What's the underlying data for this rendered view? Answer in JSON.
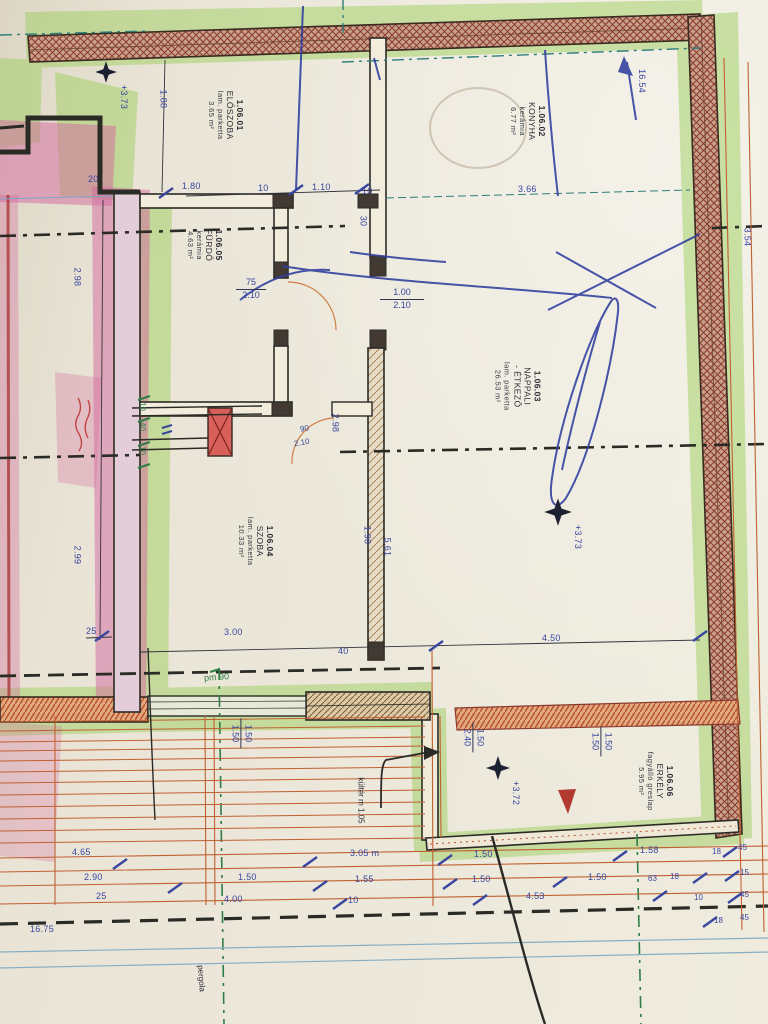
{
  "plan": {
    "rooms": [
      {
        "num": "1.06.01",
        "name": "ELŐSZOBA",
        "finish": "lam. parketta",
        "area": "3.65 m²"
      },
      {
        "num": "1.06.02",
        "name": "KONYHA",
        "finish": "kerámia",
        "area": "6.77 m²"
      },
      {
        "num": "1.06.03",
        "name": "NAPPALI",
        "name2": "- ÉTKEZŐ",
        "finish": "lam. parketta",
        "area": "26.53 m²"
      },
      {
        "num": "1.06.04",
        "name": "SZOBA",
        "finish": "lam. parketta",
        "area": "10.33 m²"
      },
      {
        "num": "1.06.05",
        "name": "FÜRDŐ",
        "finish": "kerámia",
        "area": "4.63 m²"
      },
      {
        "num": "1.06.06",
        "name": "ERKÉLY",
        "finish": "fagyálló greslap",
        "area": "5.95 m²"
      }
    ],
    "levels": {
      "entry": "+3.73",
      "living": "+3.73",
      "balcony": "+3.72"
    },
    "doors": {
      "bath": {
        "w": "75",
        "h": "2.10"
      },
      "living": {
        "w": "1.00",
        "h": "2.10"
      },
      "room": {
        "w": "90",
        "h": "2.10"
      },
      "balcony": {
        "w": "1.50",
        "h": "2.40"
      },
      "window_left": {
        "w": "1.50",
        "h": "1.50"
      },
      "window_right": {
        "w": "1.50",
        "h": "1.50"
      }
    },
    "notes": {
      "pm": "pm 90",
      "kulter": "kültér m 1.05",
      "pergola": "pergola"
    },
    "dims": {
      "top": {
        "a": "20",
        "b": "1.80",
        "c": "10",
        "d": "1.10",
        "e": "10",
        "f": "3.66",
        "g": "1.88",
        "h": "16.54"
      },
      "left": {
        "a": "2.98",
        "b": "2.99",
        "c": "25"
      },
      "right": {
        "a": "3.54"
      },
      "mid": {
        "a": "30",
        "b": "2.98",
        "c": "1.90",
        "d": "5.61",
        "e": "3.00",
        "f": "40",
        "g": "4.50",
        "h": "10",
        "i": "40",
        "j": "10"
      },
      "row1": {
        "a": "4.65",
        "b": "3.05 m",
        "c": "1.50",
        "d": "1.58",
        "e": "18",
        "f": "45"
      },
      "row2": {
        "a": "2.90",
        "b": "1.50",
        "c": "1.55",
        "d": "1.50",
        "e": "1.50",
        "f": "63",
        "g": "18",
        "h": "15"
      },
      "row3": {
        "a": "25",
        "b": "4.00",
        "c": "10",
        "d": "4.53",
        "e": "10",
        "f": "45"
      },
      "row4": {
        "a": "16.75",
        "b": "18",
        "c": "45"
      }
    }
  },
  "colors": {
    "highlight_green": "#9fcf60",
    "highlight_pink": "#d4679d",
    "wall_hatch": "#9c4632",
    "dim_blue": "#3946a0",
    "line_orange": "#c06033",
    "note_green": "#2f7d46",
    "teal": "#2e7d7a"
  }
}
